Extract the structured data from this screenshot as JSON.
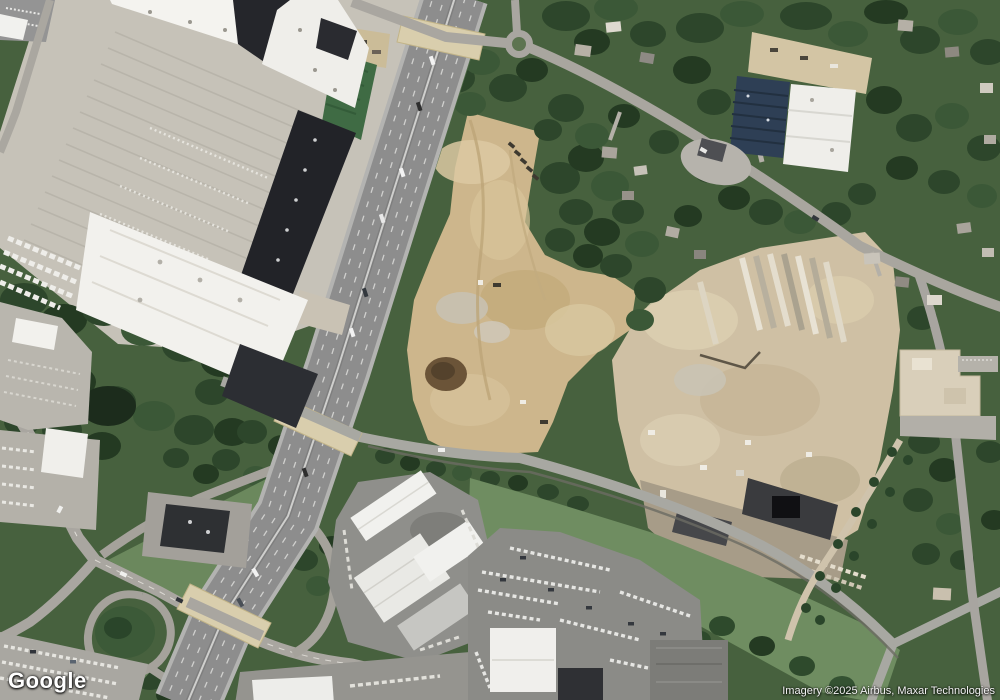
{
  "map": {
    "type": "satellite-imagery",
    "watermark": "Google",
    "attribution": "Imagery ©2025 Airbus, Maxar Technologies",
    "colors": {
      "forest": "#2f4a2c",
      "grass": "#6f8d61",
      "dirt_site": "#cdb68c",
      "rubble_site": "#cfc0a4",
      "highway_pavement": "#8d8d8d",
      "parking_lot": "#c6c2b8",
      "roof_white": "#f2f1ed",
      "roof_dark": "#25262b",
      "bridge_deck": "#d9cead",
      "solar_roof": "#2e3f55"
    }
  }
}
